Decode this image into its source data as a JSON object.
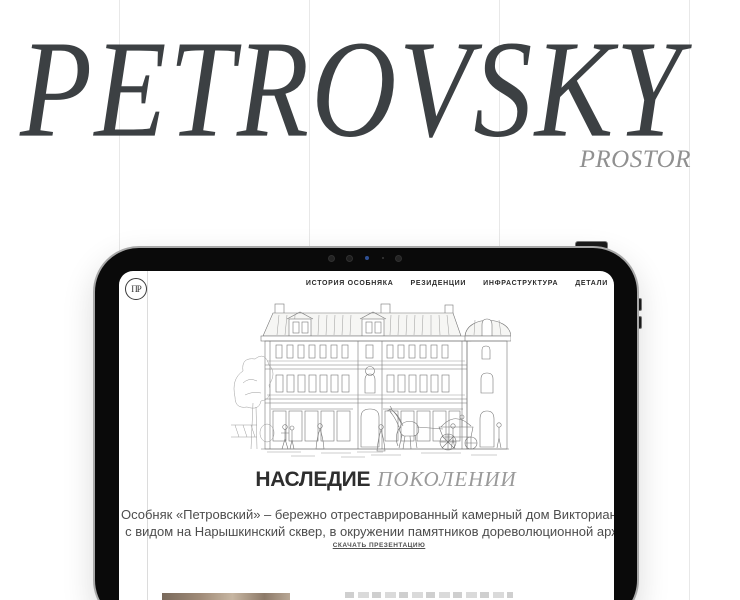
{
  "hero": {
    "title": "PETROVSKY",
    "subtitle": "PROSTOR"
  },
  "site": {
    "logo_monogram": "ПР",
    "nav": [
      "ИСТОРИЯ ОСОБНЯКА",
      "РЕЗИДЕНЦИИ",
      "ИНФРАСТРУКТУРА",
      "ДЕТАЛИ"
    ],
    "heading_main": "НАСЛЕДИЕ",
    "heading_accent": "ПОКОЛЕНИИ",
    "paragraph_line1": "Особняк «Петровский» – бережно отреставрированный камерный дом Викторианской эпохи",
    "paragraph_line2": "с видом на Нарышкинский сквер, в окружении памятников дореволюционной архитектуры",
    "download_link": "СКАЧАТЬ ПРЕЗЕНТАЦИЮ"
  },
  "colors": {
    "hero_title": "#3c4043",
    "hero_subtitle": "#909090",
    "grid_line": "#e8e8e8",
    "tablet_bezel": "#0a0a0a",
    "accent_text": "#2e2e2e",
    "muted_text": "#9a9a9a"
  }
}
